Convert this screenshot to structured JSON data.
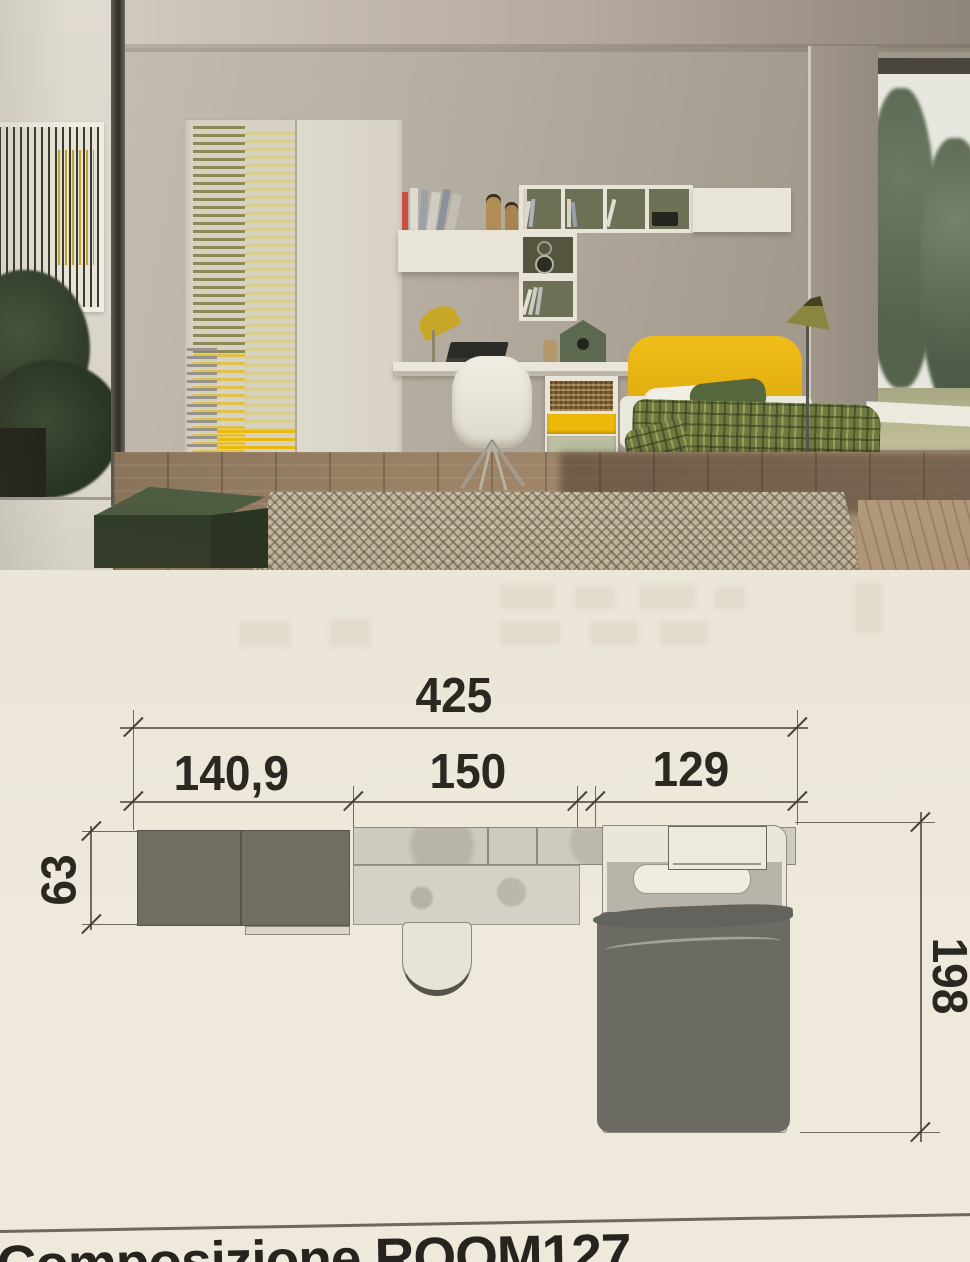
{
  "page": {
    "caption": "Composizione ROOM127"
  },
  "plan": {
    "total_width": "425",
    "segment_wardrobe": "140,9",
    "segment_desk": "150",
    "segment_bed": "129",
    "depth_left": "63",
    "bed_length": "198"
  },
  "colors": {
    "accent_yellow": "#e9b511",
    "stripe_olive": "#8a8a55",
    "drawer_sage": "#b9bfa0",
    "plan_dark_gray": "#706e63",
    "paper": "#ece7d9",
    "ink": "#2b2721"
  }
}
